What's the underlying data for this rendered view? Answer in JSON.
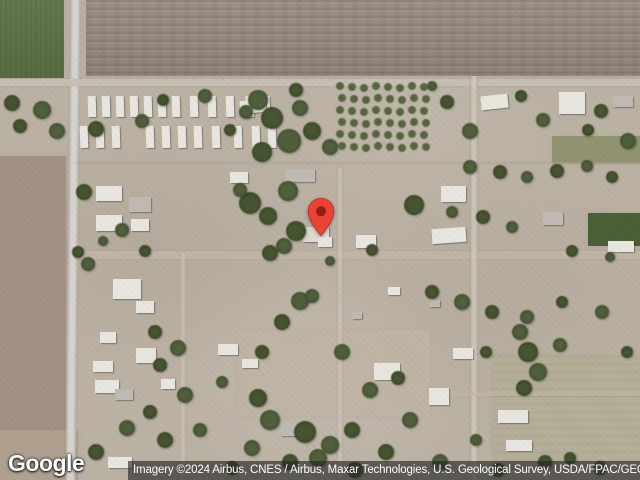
{
  "map": {
    "view_type": "satellite",
    "logo_text": "Google",
    "attribution_text": "Imagery ©2024 Airbus, CNES / Airbus, Maxar Technologies, U.S. Geological Survey, USDA/FPAC/GEO",
    "marker": {
      "icon": "map-pin-icon",
      "tip_x": 321,
      "tip_y": 237,
      "body_color": "#EA4335",
      "dot_color": "#8E2015",
      "outline_color": "#C5221F"
    }
  },
  "palette": {
    "ground": "#bcb2a4",
    "plowed_field": "#9a8c82",
    "green_field": "#5d7345",
    "left_field": "#a39185",
    "left_field_bottom": "#b0a090",
    "olive_strip": "#7c8455",
    "dark_green_field": "#4b5f35",
    "pale_field": "#b5ae97",
    "center_lot": "#c1b5a4",
    "road": "#c8c4bc",
    "dirt_road": "#c3b8a7",
    "building_white": "#e9e6e0",
    "building_gray": "#bfbbb3",
    "tree_dark": "#46552f",
    "tree_light": "#50603a",
    "orchard_tree": "#4f5e36"
  },
  "scenery": {
    "fields": [
      {
        "x": 0,
        "y": 0,
        "w": 64,
        "h": 78,
        "color": "#5d7345",
        "tex": "green",
        "op": 1
      },
      {
        "x": 86,
        "y": 0,
        "w": 554,
        "h": 76,
        "color": "#9a8c82",
        "tex": "plow",
        "op": 1
      },
      {
        "x": 0,
        "y": 156,
        "w": 66,
        "h": 296,
        "color": "#a39185",
        "tex": "",
        "op": 1
      },
      {
        "x": 0,
        "y": 430,
        "w": 78,
        "h": 50,
        "color": "#b0a090",
        "tex": "",
        "op": 1
      },
      {
        "x": 552,
        "y": 136,
        "w": 88,
        "h": 28,
        "color": "#7c8455",
        "tex": "",
        "op": 0.65
      },
      {
        "x": 588,
        "y": 213,
        "w": 52,
        "h": 33,
        "color": "#4b5f35",
        "tex": "",
        "op": 1
      },
      {
        "x": 492,
        "y": 356,
        "w": 148,
        "h": 112,
        "color": "#b5ae97",
        "tex": "lines",
        "op": 0.9
      },
      {
        "x": 238,
        "y": 330,
        "w": 192,
        "h": 86,
        "color": "#c1b5a4",
        "tex": "",
        "op": 0.85
      }
    ],
    "roads": [
      {
        "dir": "v",
        "x": 68,
        "y": 0,
        "w": 10,
        "h": 480,
        "color": "#c8c4bc",
        "op": 1,
        "rot": 0.6
      },
      {
        "dir": "h",
        "x": 0,
        "y": 79,
        "w": 640,
        "h": 7,
        "color": "#c6bfb3",
        "op": 1,
        "rot": 0
      },
      {
        "dir": "h",
        "x": 74,
        "y": 251,
        "w": 566,
        "h": 8,
        "color": "#c3b8a7",
        "op": 0.75,
        "rot": 0
      },
      {
        "dir": "v",
        "x": 470,
        "y": 76,
        "w": 8,
        "h": 404,
        "color": "#c3b8a7",
        "op": 0.7,
        "rot": 0
      },
      {
        "dir": "v",
        "x": 337,
        "y": 168,
        "w": 6,
        "h": 312,
        "color": "#c3b8a7",
        "op": 0.5,
        "rot": 0
      },
      {
        "dir": "v",
        "x": 180,
        "y": 253,
        "w": 6,
        "h": 227,
        "color": "#c3b8a7",
        "op": 0.45,
        "rot": 0
      },
      {
        "dir": "h",
        "x": 76,
        "y": 162,
        "w": 564,
        "h": 2,
        "color": "#b0a595",
        "op": 0.5,
        "rot": 0
      },
      {
        "dir": "h",
        "x": 427,
        "y": 391,
        "w": 213,
        "h": 5,
        "color": "#c3b8a7",
        "op": 0.5,
        "rot": 0
      }
    ],
    "trailer_rows": [
      {
        "y": 96,
        "h": 21,
        "w": 8,
        "xs": [
          88,
          102,
          116,
          130,
          144,
          158,
          172,
          190,
          208,
          226,
          246,
          262
        ]
      },
      {
        "y": 126,
        "h": 22,
        "w": 8,
        "xs": [
          80,
          96,
          112,
          146,
          162,
          178,
          194,
          212,
          234,
          252,
          268
        ]
      }
    ],
    "buildings": [
      [
        240,
        100,
        26,
        13,
        "#e9e6e0",
        -6
      ],
      [
        285,
        169,
        30,
        13,
        "#bfbbb3",
        0
      ],
      [
        230,
        172,
        18,
        11,
        "#e9e6e0",
        0
      ],
      [
        96,
        186,
        26,
        15,
        "#e9e6e0",
        0
      ],
      [
        129,
        197,
        22,
        15,
        "#bfbbb3",
        0
      ],
      [
        96,
        215,
        26,
        16,
        "#e9e6e0",
        0
      ],
      [
        131,
        219,
        18,
        12,
        "#e9e6e0",
        0
      ],
      [
        303,
        227,
        26,
        15,
        "#ddd8d0",
        0
      ],
      [
        318,
        237,
        14,
        10,
        "#e9e6e0",
        0
      ],
      [
        356,
        235,
        20,
        13,
        "#e9e6e0",
        0
      ],
      [
        432,
        228,
        34,
        15,
        "#e9e6e0",
        -4
      ],
      [
        441,
        186,
        25,
        16,
        "#e9e6e0",
        0
      ],
      [
        543,
        212,
        20,
        13,
        "#bfbbb3",
        0
      ],
      [
        608,
        241,
        26,
        11,
        "#e9e6e0",
        0
      ],
      [
        481,
        95,
        27,
        14,
        "#e9e6e0",
        -6
      ],
      [
        559,
        92,
        26,
        22,
        "#e9e6e0",
        0
      ],
      [
        613,
        96,
        20,
        11,
        "#bfbbb3",
        0
      ],
      [
        113,
        279,
        28,
        20,
        "#e9e6e0",
        0
      ],
      [
        136,
        301,
        18,
        12,
        "#e9e6e0",
        0
      ],
      [
        100,
        332,
        16,
        11,
        "#e9e6e0",
        0
      ],
      [
        136,
        348,
        20,
        15,
        "#e9e6e0",
        0
      ],
      [
        93,
        361,
        20,
        11,
        "#e9e6e0",
        0
      ],
      [
        95,
        380,
        24,
        13,
        "#e9e6e0",
        0
      ],
      [
        115,
        389,
        18,
        11,
        "#bfbbb3",
        0
      ],
      [
        161,
        379,
        14,
        10,
        "#e9e6e0",
        0
      ],
      [
        218,
        344,
        20,
        11,
        "#e9e6e0",
        0
      ],
      [
        242,
        359,
        16,
        9,
        "#e9e6e0",
        0
      ],
      [
        281,
        423,
        20,
        13,
        "#bfbbb3",
        0
      ],
      [
        374,
        363,
        26,
        17,
        "#e9e6e0",
        0
      ],
      [
        453,
        348,
        20,
        11,
        "#e9e6e0",
        0
      ],
      [
        429,
        388,
        20,
        17,
        "#e9e6e0",
        0
      ],
      [
        498,
        410,
        30,
        13,
        "#e9e6e0",
        0
      ],
      [
        506,
        440,
        26,
        11,
        "#e9e6e0",
        0
      ],
      [
        108,
        457,
        24,
        11,
        "#e9e6e0",
        0
      ],
      [
        388,
        287,
        12,
        8,
        "#e9e6e0",
        0
      ],
      [
        430,
        300,
        10,
        7,
        "#bfbbb3",
        0
      ],
      [
        352,
        312,
        10,
        7,
        "#bfbbb3",
        0
      ]
    ],
    "trees": [
      [
        12,
        103,
        8
      ],
      [
        42,
        110,
        9
      ],
      [
        20,
        126,
        7
      ],
      [
        57,
        131,
        8
      ],
      [
        96,
        129,
        8
      ],
      [
        142,
        121,
        7
      ],
      [
        163,
        100,
        6
      ],
      [
        205,
        96,
        7
      ],
      [
        230,
        130,
        6
      ],
      [
        258,
        100,
        10
      ],
      [
        272,
        118,
        11
      ],
      [
        289,
        141,
        12
      ],
      [
        262,
        152,
        10
      ],
      [
        300,
        108,
        8
      ],
      [
        312,
        131,
        9
      ],
      [
        330,
        147,
        8
      ],
      [
        296,
        90,
        7
      ],
      [
        246,
        112,
        7
      ],
      [
        447,
        102,
        7
      ],
      [
        470,
        131,
        8
      ],
      [
        521,
        96,
        6
      ],
      [
        543,
        120,
        7
      ],
      [
        601,
        111,
        7
      ],
      [
        628,
        141,
        8
      ],
      [
        588,
        130,
        6
      ],
      [
        432,
        86,
        5
      ],
      [
        84,
        192,
        8
      ],
      [
        122,
        230,
        7
      ],
      [
        78,
        252,
        6
      ],
      [
        88,
        264,
        7
      ],
      [
        145,
        251,
        6
      ],
      [
        103,
        241,
        5
      ],
      [
        250,
        203,
        11
      ],
      [
        288,
        191,
        10
      ],
      [
        268,
        216,
        9
      ],
      [
        240,
        190,
        7
      ],
      [
        296,
        231,
        10
      ],
      [
        284,
        246,
        8
      ],
      [
        270,
        253,
        8
      ],
      [
        300,
        301,
        9
      ],
      [
        282,
        322,
        8
      ],
      [
        312,
        296,
        7
      ],
      [
        414,
        205,
        10
      ],
      [
        342,
        352,
        8
      ],
      [
        262,
        352,
        7
      ],
      [
        330,
        261,
        5
      ],
      [
        372,
        250,
        6
      ],
      [
        470,
        167,
        7
      ],
      [
        500,
        172,
        7
      ],
      [
        527,
        177,
        6
      ],
      [
        557,
        171,
        7
      ],
      [
        587,
        166,
        6
      ],
      [
        612,
        177,
        6
      ],
      [
        452,
        212,
        6
      ],
      [
        483,
        217,
        7
      ],
      [
        512,
        227,
        6
      ],
      [
        572,
        251,
        6
      ],
      [
        610,
        257,
        5
      ],
      [
        432,
        292,
        7
      ],
      [
        462,
        302,
        8
      ],
      [
        492,
        312,
        7
      ],
      [
        527,
        317,
        7
      ],
      [
        562,
        302,
        6
      ],
      [
        602,
        312,
        7
      ],
      [
        155,
        332,
        7
      ],
      [
        178,
        348,
        8
      ],
      [
        160,
        365,
        7
      ],
      [
        185,
        395,
        8
      ],
      [
        150,
        412,
        7
      ],
      [
        127,
        428,
        8
      ],
      [
        165,
        440,
        8
      ],
      [
        200,
        430,
        7
      ],
      [
        96,
        452,
        8
      ],
      [
        222,
        382,
        6
      ],
      [
        258,
        398,
        9
      ],
      [
        270,
        420,
        10
      ],
      [
        305,
        432,
        11
      ],
      [
        330,
        445,
        9
      ],
      [
        352,
        430,
        8
      ],
      [
        318,
        458,
        9
      ],
      [
        290,
        462,
        8
      ],
      [
        252,
        448,
        8
      ],
      [
        232,
        468,
        7
      ],
      [
        370,
        390,
        8
      ],
      [
        398,
        378,
        7
      ],
      [
        410,
        420,
        8
      ],
      [
        386,
        452,
        8
      ],
      [
        440,
        462,
        8
      ],
      [
        355,
        470,
        8
      ],
      [
        520,
        332,
        8
      ],
      [
        528,
        352,
        10
      ],
      [
        538,
        372,
        9
      ],
      [
        524,
        388,
        8
      ],
      [
        560,
        345,
        7
      ],
      [
        486,
        352,
        6
      ],
      [
        600,
        468,
        7
      ],
      [
        570,
        458,
        6
      ],
      [
        498,
        470,
        7
      ],
      [
        627,
        352,
        6
      ],
      [
        476,
        440,
        6
      ],
      [
        545,
        462,
        7
      ]
    ],
    "orchard": {
      "x": 340,
      "y": 86,
      "cols": 8,
      "rows": 6,
      "dx": 12,
      "dy": 12,
      "r": 4
    }
  }
}
